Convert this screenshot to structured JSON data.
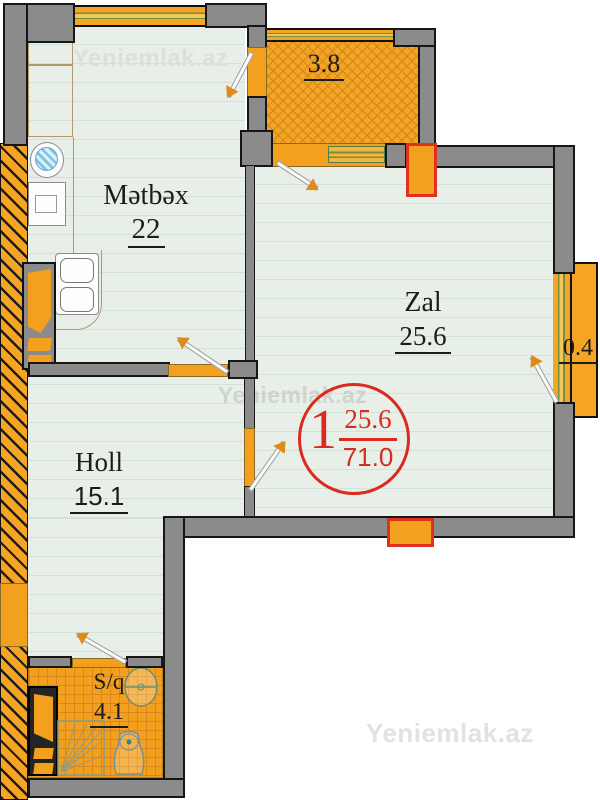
{
  "site": {
    "watermark": "Yeniemlak.az"
  },
  "rooms": {
    "kitchen": {
      "name": "Mətbəx",
      "area": "22"
    },
    "living": {
      "name": "Zal",
      "area": "25.6"
    },
    "hall": {
      "name": "Holl",
      "area": "15.1"
    },
    "bathroom": {
      "name": "S/q",
      "area": "4.1"
    },
    "balcony_top": {
      "area": "3.8"
    },
    "balcony_right": {
      "area": "0.4"
    }
  },
  "badge": {
    "room_count": "1",
    "living_area": "25.6",
    "total_area": "71.0"
  },
  "colors": {
    "wall_gray": "#8b8b8b",
    "accent_orange": "#f5a424",
    "accent_red": "#d92b1f",
    "room_fill": "#e7efe8",
    "window_green": "#71913d",
    "watermark_gray": "#dedede"
  }
}
